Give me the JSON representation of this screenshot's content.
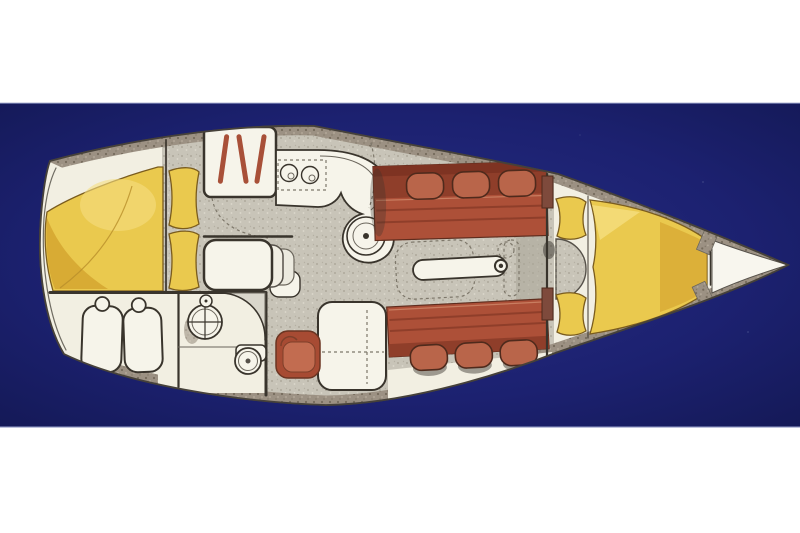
{
  "scene": {
    "kind": "sailboat-interior-floorplan-illustration",
    "orientation": "overhead plan view, bow pointing right, stern at left",
    "background": "navy photo band with white letterbox bands above and below",
    "text_content": "none - image contains no text"
  },
  "colors": {
    "page-white": "#ffffff",
    "photo-navy": "#1c2170",
    "photo-navy-light": "#262d83",
    "photo-navy-deep": "#121750",
    "band-line": "#8b93c1",
    "hull-cream": "#f2efe2",
    "hull-bright": "#f8f6ee",
    "hull-outline": "#46413a",
    "deck-rim": "#9c9183",
    "deck-rim-dark": "#756b5c",
    "deck-rim-light": "#b7ad9d",
    "floor-grey": "#c8c4b8",
    "floor-grey-dark": "#a9a496",
    "floor-grey-light": "#ddd9cd",
    "line-dark": "#39342c",
    "line-mid": "#6b665c",
    "dash-grey": "#7d776a",
    "white-furniture": "#f6f4ea",
    "berth-yellow": "#eac94e",
    "berth-yellow-deep": "#d2a02c",
    "berth-yellow-light": "#f5de80",
    "yellow-outline": "#7a5c1e",
    "settee-red": "#ad5038",
    "settee-red-dark": "#8f3e2a",
    "settee-red-deep": "#7e3322",
    "settee-pillow": "#b9654a",
    "settee-highlight": "#c97d60",
    "stove-red": "#a85038",
    "wardrobe-brown": "#7e4a3c",
    "nav-seat-red": "#a74b33",
    "nav-seat-inner": "#c26c50",
    "shadow-dark": "#35312b"
  },
  "regions": [
    {
      "name": "hull",
      "color_key": "hull-cream"
    },
    {
      "name": "deck-rim",
      "color_key": "deck-rim",
      "style": "speckled band along hull edges"
    },
    {
      "name": "aft-cabin-double-berth",
      "color_key": "berth-yellow"
    },
    {
      "name": "aft-berth-pillows",
      "color_key": "berth-yellow",
      "count": 2
    },
    {
      "name": "aft-seat-cushions",
      "color_key": "white-furniture",
      "count": 2
    },
    {
      "name": "galley",
      "items": [
        "stove-with-fiddle-rails",
        "twin-sinks",
        "curved-counter",
        "round-sink"
      ]
    },
    {
      "name": "companionway-steps",
      "count": 3
    },
    {
      "name": "head-compartment",
      "items": [
        "washbasin-with-cross",
        "faucet",
        "toilet",
        "door-swing"
      ]
    },
    {
      "name": "nav-station",
      "items": [
        "chart-table",
        "nav-seat"
      ]
    },
    {
      "name": "saloon",
      "items": [
        "upper-settee-with-3-cushions",
        "lower-settee-with-3-cushions",
        "centerline-table",
        "mast-post",
        "folded-table-leaf-dashed"
      ]
    },
    {
      "name": "forward-cabin",
      "items": [
        "v-berth-mattress",
        "v-berth-pillows",
        "wardrobes",
        "entry-half-round-seat"
      ]
    },
    {
      "name": "anchor-locker",
      "color_key": "hull-bright"
    }
  ]
}
